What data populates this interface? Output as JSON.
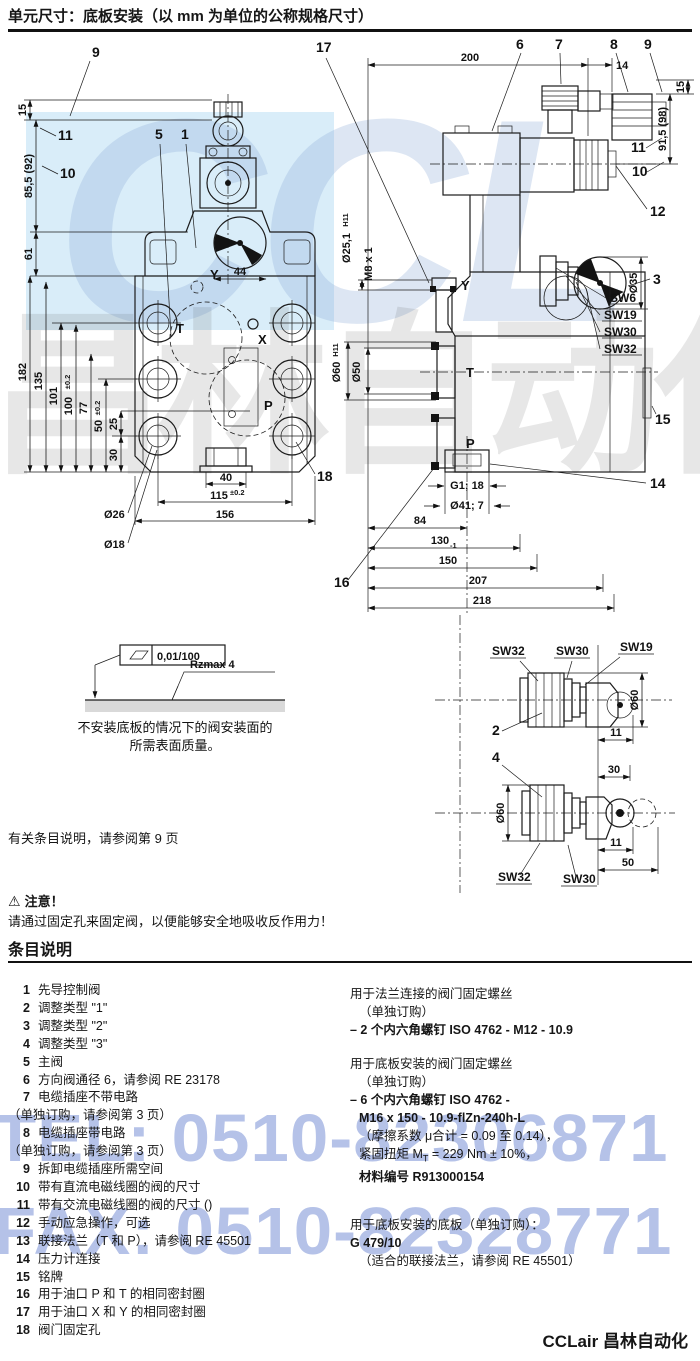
{
  "title": "单元尺寸：底板安装（以 mm 为单位的公称规格尺寸）",
  "watermark": {
    "tel": "TEL: 0510-82306871",
    "fax": "FAX: 0510-82328771",
    "logo": "CCL",
    "logo_cn": "昌林自动化"
  },
  "fv": {
    "c9": "9",
    "c11": "11",
    "c10": "10",
    "c5": "5",
    "c1": "1",
    "c17": "17",
    "c18": "18",
    "d15": "15",
    "d85": "85,5 (92)",
    "d61": "61",
    "d182": "182",
    "d135": "135",
    "d101": "101",
    "d100": "100",
    "d100t": "±0.2",
    "d77": "77",
    "d50": "50",
    "d50t": "±0.2",
    "d25": "25",
    "d30": "30",
    "d44": "44",
    "d40": "40",
    "d115": "115",
    "d115t": "±0.2",
    "d156": "156",
    "dia26": "Ø26",
    "dia18": "Ø18",
    "pY": "Y",
    "pT": "T",
    "pX": "X",
    "pP": "P"
  },
  "sv": {
    "c6": "6",
    "c7": "7",
    "c8": "8",
    "c9": "9",
    "c10": "10",
    "c11": "11",
    "c12": "12",
    "c3": "3",
    "c14": "14",
    "c15": "15",
    "c16": "16",
    "d200": "200",
    "d14": "14",
    "d15": "15",
    "d915": "91,5 (98)",
    "dia251": "Ø25,1",
    "dia251t": "H11",
    "dm8": "M8 x 1",
    "dia60": "Ø60",
    "dia60t": "H11",
    "dia50": "Ø50",
    "dia35": "Ø35",
    "sw6": "SW6",
    "sw19": "SW19",
    "sw30": "SW30",
    "sw32": "SW32",
    "dg1": "G1; 18",
    "dia41": "Ø41; 7",
    "d84": "84",
    "d130": "130",
    "d130t": "-1",
    "d150": "150",
    "d207": "207",
    "d218": "218",
    "pY": "Y",
    "pT": "T",
    "pP": "P"
  },
  "da": {
    "c2": "2",
    "sw32": "SW32",
    "sw30": "SW30",
    "sw19": "SW19",
    "dia60": "Ø60",
    "d11": "11"
  },
  "db": {
    "c4": "4",
    "sw32": "SW32",
    "sw30": "SW30",
    "dia60": "Ø60",
    "d11": "11",
    "d30": "30",
    "d50": "50"
  },
  "surface": {
    "flatness": "0,01/100",
    "rough": "Rzmax  4",
    "cap1": "不安装底板的情况下的阀安装面的",
    "cap2": "所需表面质量。"
  },
  "ref_note": "有关条目说明，请参阅第 9 页",
  "warning": {
    "icon": "⚠",
    "title": "注意！",
    "text": "请通过固定孔来固定阀，以便能够安全地吸收反作用力！"
  },
  "section_heading": "条目说明",
  "items": [
    {
      "num": "1",
      "text": "先导控制阀"
    },
    {
      "num": "2",
      "text": "调整类型 \"1\""
    },
    {
      "num": "3",
      "text": "调整类型 \"2\""
    },
    {
      "num": "4",
      "text": "调整类型 \"3\""
    },
    {
      "num": "5",
      "text": "主阀"
    },
    {
      "num": "6",
      "text": "方向阀通径 6，请参阅 RE 23178"
    },
    {
      "num": "7",
      "text": "电缆插座不带电路",
      "note": "（单独订购，请参阅第 3 页）"
    },
    {
      "num": "8",
      "text": "电缆插座带电路",
      "note": "（单独订购，请参阅第 3 页）"
    },
    {
      "num": "9",
      "text": "拆卸电缆插座所需空间"
    },
    {
      "num": "10",
      "text": "带有直流电磁线圈的阀的尺寸"
    },
    {
      "num": "11",
      "text": "带有交流电磁线圈的阀的尺寸 ()"
    },
    {
      "num": "12",
      "text": "手动应急操作，可选"
    },
    {
      "num": "13",
      "text": "联接法兰（T 和 P），请参阅 RE 45501"
    },
    {
      "num": "14",
      "text": "压力计连接"
    },
    {
      "num": "15",
      "text": "铭牌"
    },
    {
      "num": "16",
      "text": "用于油口 P 和 T 的相同密封圈"
    },
    {
      "num": "17",
      "text": "用于油口 X 和 Y 的相同密封圈"
    },
    {
      "num": "18",
      "text": "阀门固定孔"
    }
  ],
  "screws": {
    "flange_title": "用于法兰连接的阀门固定螺丝",
    "flange_sub": "（单独订购）",
    "flange_item": "– 2 个内六角螺钉 ISO 4762 - M12 - 10.9",
    "plate_title": "用于底板安装的阀门固定螺丝",
    "plate_sub": "（单独订购）",
    "plate_l1": "– 6 个内六角螺钉 ISO 4762 -",
    "plate_l2": "M16 x 150 - 10.9-flZn-240h-L",
    "plate_l3": "（摩擦系数 μ合计 = 0.09 至 0.14），",
    "plate_l4a": "紧固扭矩 M",
    "plate_l4sub": "T",
    "plate_l4b": " = 229 Nm ± 10%，",
    "plate_l5": "材料编号 R913000154",
    "subplate_title": "用于底板安装的底板（单独订购）：",
    "subplate_model": "G 479/10",
    "subplate_note": "（适合的联接法兰，请参阅 RE 45501）"
  },
  "footer": {
    "brand": "CCLair 昌林自动化"
  }
}
